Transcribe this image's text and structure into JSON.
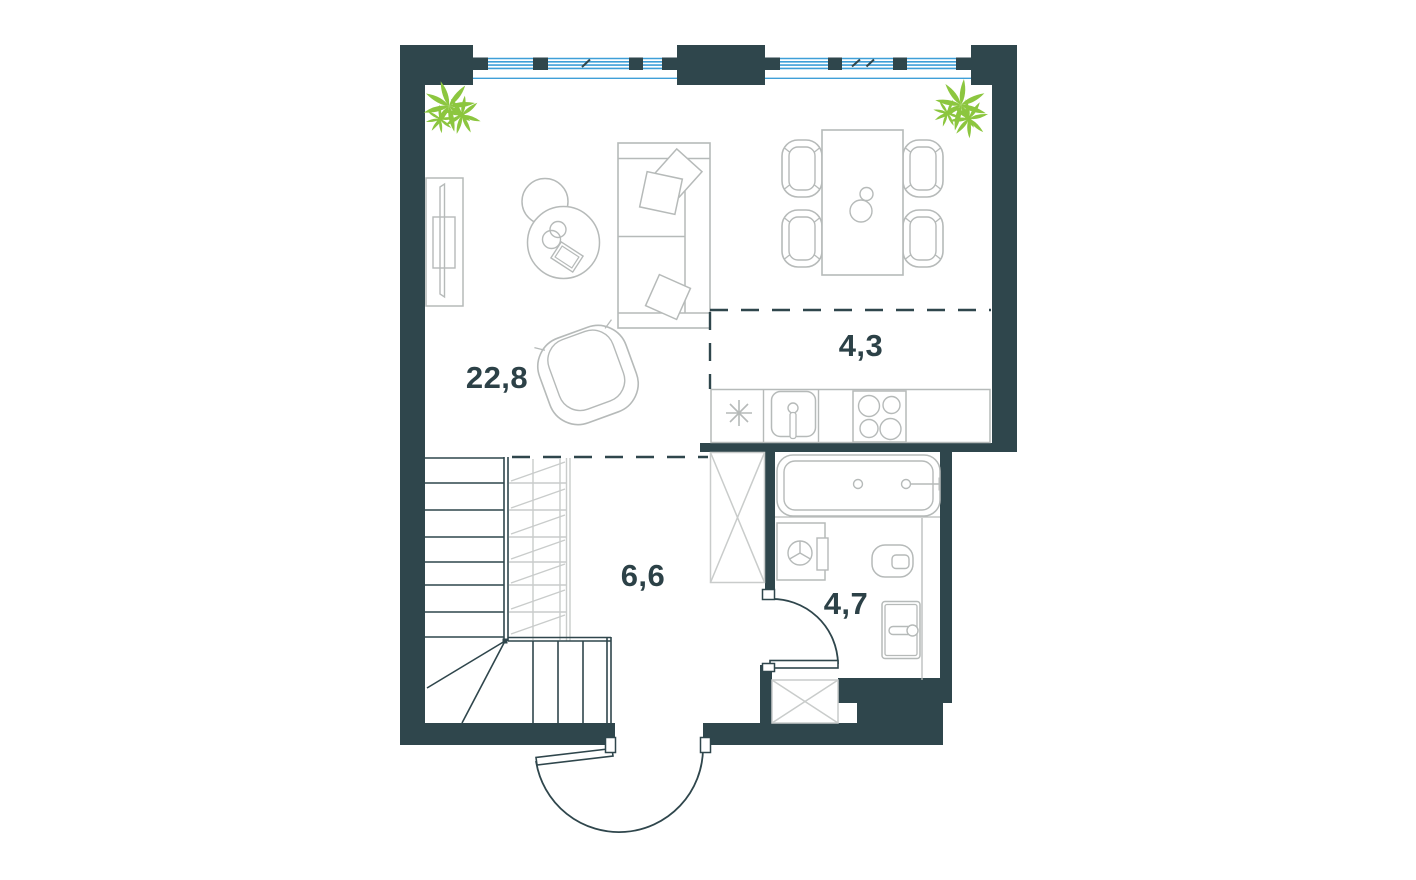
{
  "rooms": {
    "living": {
      "area": "22,8"
    },
    "kitchen": {
      "area": "4,3"
    },
    "hall": {
      "area": "6,6"
    },
    "bath": {
      "area": "4,7"
    }
  },
  "colors": {
    "wall": "#2f464c",
    "furniture": "#b6bab9",
    "stair_light": "#c9cccb",
    "window_blue": "#3f9fd8",
    "plant_green": "#8cc63f",
    "label": "#2c4147",
    "background": "#ffffff"
  },
  "icons": {
    "plant-icon": "green-leaf-cluster",
    "fridge-icon": "asterisk-star",
    "wardrobe-icon": "tall-crossed-box",
    "duct-shaft-icon": "crossed-box",
    "window-icon": "blue-glazing-lines"
  }
}
